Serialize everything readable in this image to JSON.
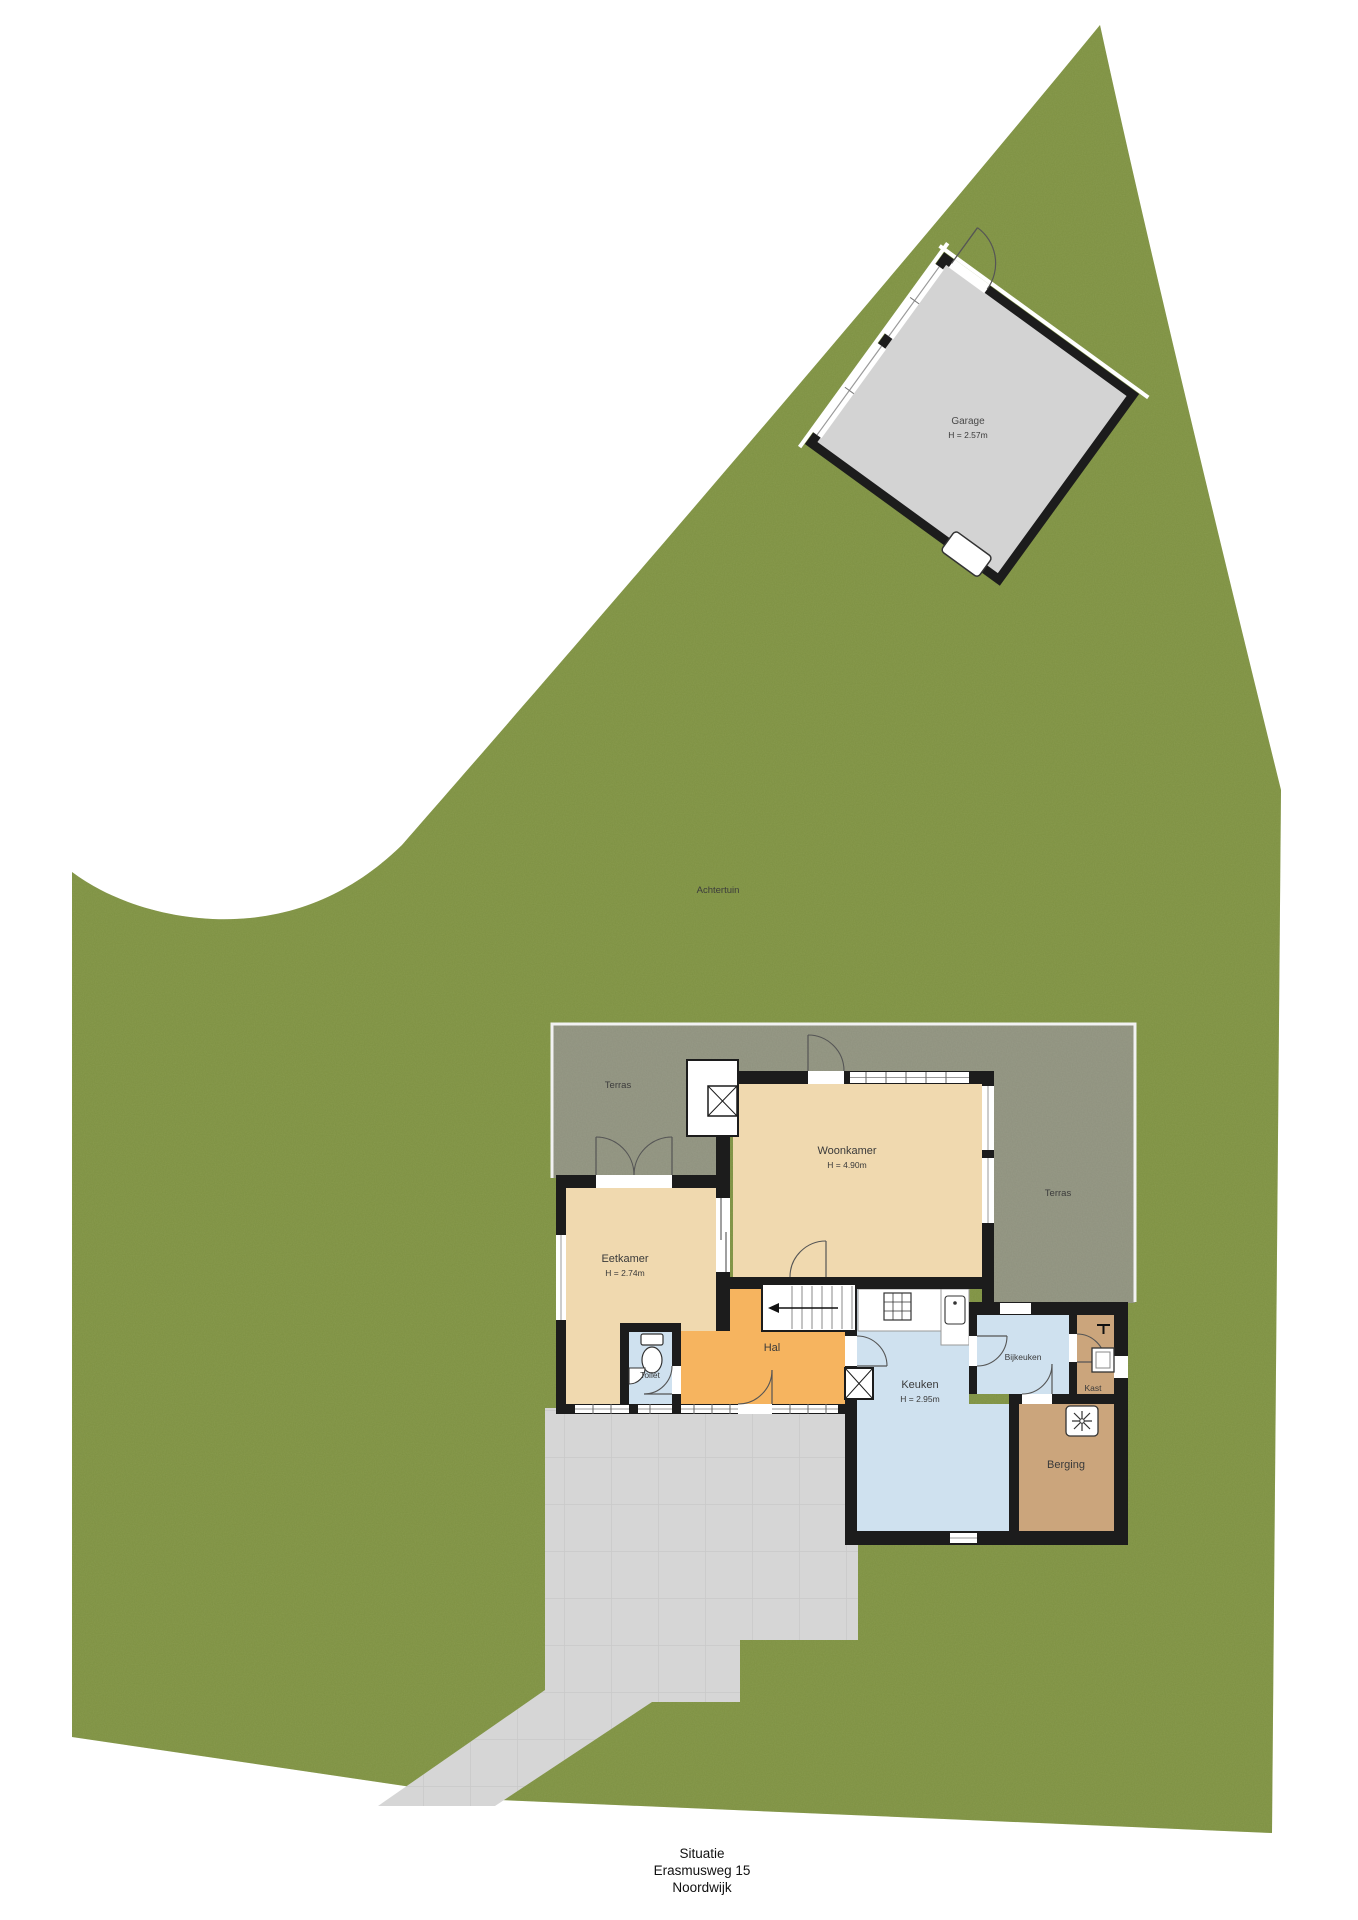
{
  "title": {
    "line1": "Situatie",
    "line2": "Erasmusweg 15",
    "line3": "Noordwijk"
  },
  "site": {
    "garden_label": "Achtertuin",
    "terrace_left_label": "Terras",
    "terrace_right_label": "Terras",
    "garage": {
      "name": "Garage",
      "height": "H = 2.57m"
    }
  },
  "rooms": {
    "woonkamer": {
      "name": "Woonkamer",
      "height": "H = 4.90m"
    },
    "eetkamer": {
      "name": "Eetkamer",
      "height": "H = 2.74m"
    },
    "keuken": {
      "name": "Keuken",
      "height": "H = 2.95m"
    },
    "hal": {
      "name": "Hal"
    },
    "toilet": {
      "name": "Toilet"
    },
    "bijkeuken": {
      "name": "Bijkeuken"
    },
    "kast": {
      "name": "Kast"
    },
    "berging": {
      "name": "Berging"
    }
  },
  "icons": {
    "stairs-icon": "stair treads with direction arrow",
    "toilet-icon": "toilet bowl with cistern",
    "corner-sink-icon": "small corner basin",
    "stove-icon": "cooktop grid",
    "kitchen-sink-icon": "sink basin",
    "duct-icon": "x-crossed shaft box",
    "chimney-icon": "x-crossed flue box",
    "fan-icon": "mechanical ventilation unit",
    "tap-icon": "wall tap",
    "utility-sink-icon": "square basin",
    "garage-opener-icon": "garage equipment box",
    "door-arc-icon": "door swing arc"
  },
  "colors": {
    "grass": "#7d9043",
    "terrace": "#8e917e",
    "paving": "#d6d6d6",
    "garage_floor": "#d3d3d3",
    "wall": "#1c1c1c",
    "floor_living": "#f0d9af",
    "floor_hall": "#f6b45f",
    "floor_wet": "#cfe1ef",
    "floor_storage": "#cba57c"
  }
}
